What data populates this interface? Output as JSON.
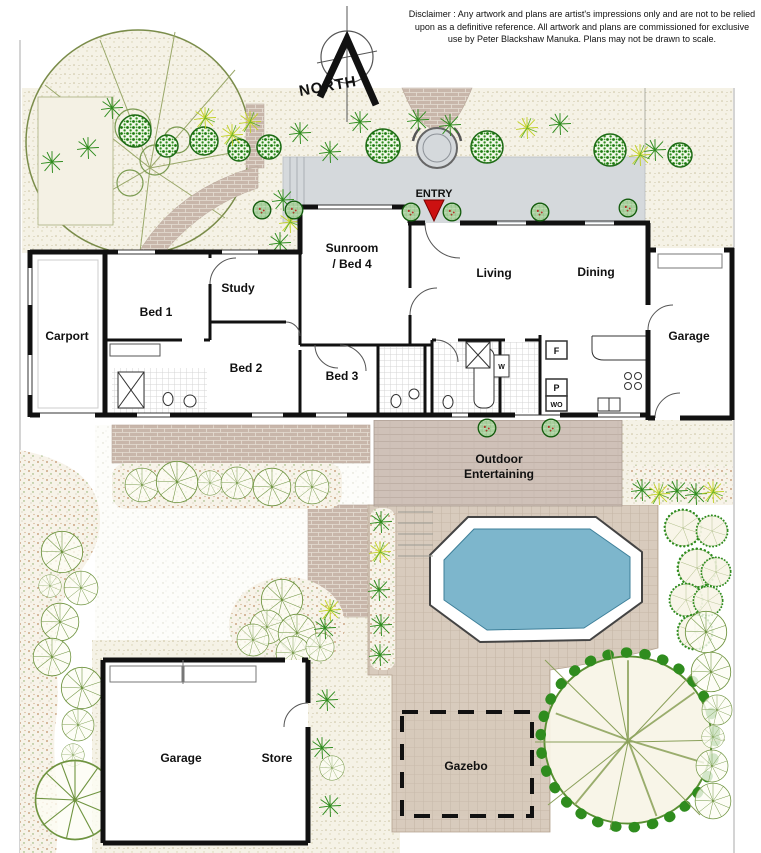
{
  "disclaimer": "Disclaimer : Any artwork and plans are artist's impressions only and are not to be relied upon as a definitive reference. All artwork and plans are commissioned for exclusive use by Peter Blackshaw Manuka. Plans may not be drawn to scale.",
  "compass": {
    "north_label": "NORTH"
  },
  "entry_label": "ENTRY",
  "rooms": {
    "carport": "Carport",
    "bed1": "Bed 1",
    "study": "Study",
    "bed2": "Bed 2",
    "bed3": "Bed 3",
    "sunroom1": "Sunroom",
    "sunroom2": "/ Bed 4",
    "living": "Living",
    "dining": "Dining",
    "garage_upper": "Garage",
    "outdoor1": "Outdoor",
    "outdoor2": "Entertaining",
    "garage_lower": "Garage",
    "store": "Store",
    "gazebo": "Gazebo"
  },
  "appliances": {
    "fridge": "F",
    "pantry": "P",
    "wall_oven": "WO",
    "washer": "W"
  },
  "colors": {
    "entry_arrow": "#cc1111",
    "pool_water": "#7db6cc",
    "path_concrete": "#d5d9dc",
    "paving_brick": "#c8b6aa",
    "deck": "#cfc1b8",
    "terrace": "#d8cbbd",
    "tree_outline": "#5a8f33",
    "shrub_green": "#1d7a10"
  }
}
